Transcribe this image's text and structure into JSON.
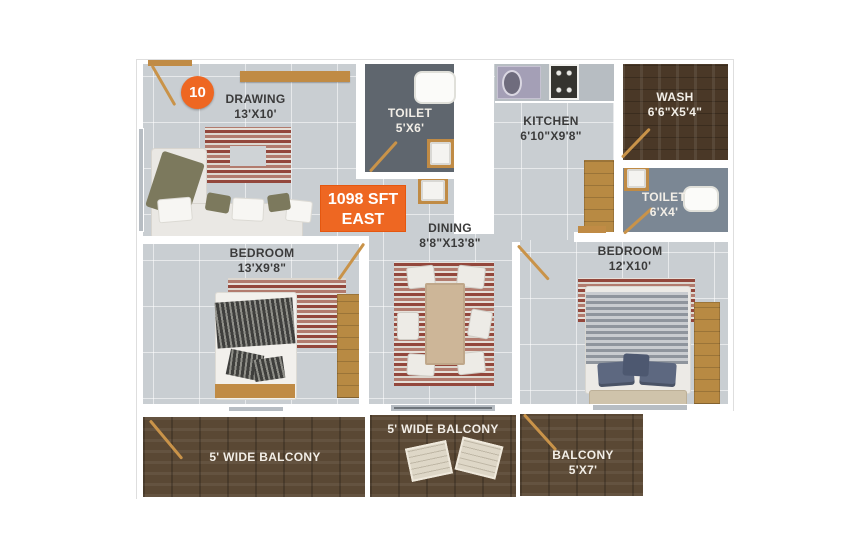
{
  "plan": {
    "unit_number": "10",
    "area": "1098 SFT",
    "facing": "EAST",
    "rooms": {
      "drawing": {
        "name": "DRAWING",
        "size": "13'X10'"
      },
      "toilet_top": {
        "name": "TOILET",
        "size": "5'X6'"
      },
      "kitchen": {
        "name": "KITCHEN",
        "size": "6'10\"X9'8\""
      },
      "wash": {
        "name": "WASH",
        "size": "6'6\"X5'4\""
      },
      "toilet_right": {
        "name": "TOILET",
        "size": "6'X4'"
      },
      "bedroom_left": {
        "name": "BEDROOM",
        "size": "13'X9'8\""
      },
      "dining": {
        "name": "DINING",
        "size": "8'8\"X13'8\""
      },
      "bedroom_right": {
        "name": "BEDROOM",
        "size": "12'X10'"
      },
      "balcony_left": {
        "name": "5' WIDE BALCONY"
      },
      "balcony_middle": {
        "name": "5' WIDE BALCONY"
      },
      "balcony_right": {
        "name": "BALCONY",
        "size": "5'X7'"
      }
    },
    "colors": {
      "accent_orange": "#ee6722",
      "floor_tile": "#c9ced2",
      "toilet_floor_dark": "#5f666e",
      "toilet_floor_blue": "#7b8794",
      "balcony_wood": "#5a4834",
      "wash_wood": "#4a3827",
      "door_wood": "#c08b45"
    }
  }
}
